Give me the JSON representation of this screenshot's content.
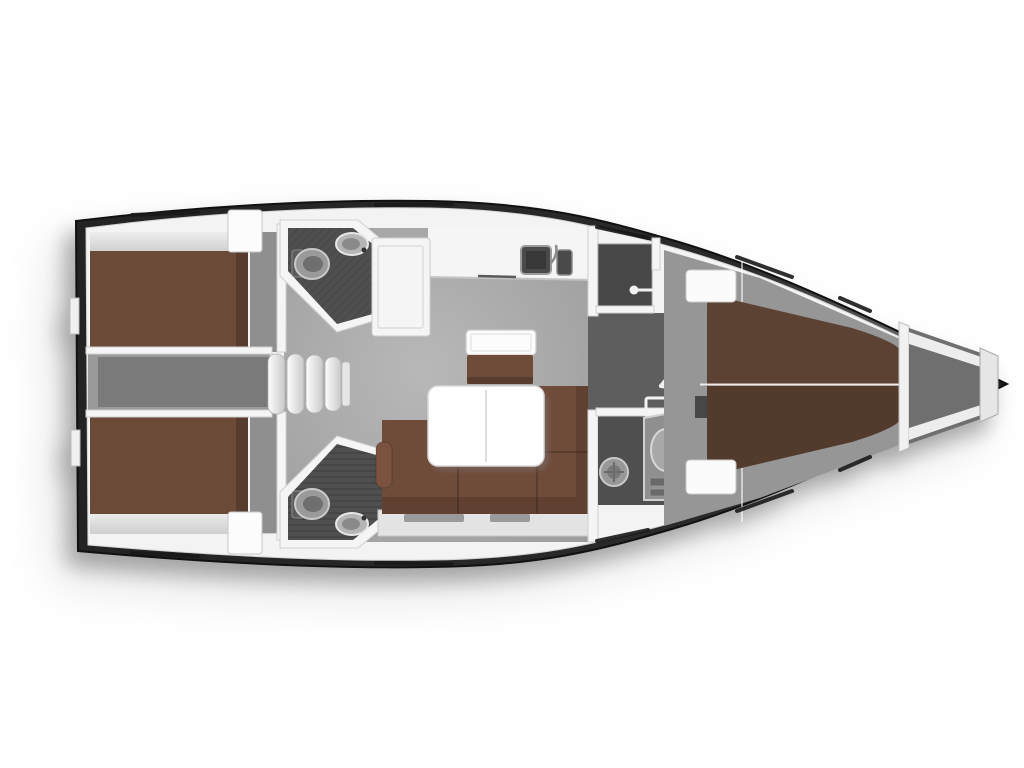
{
  "page": {
    "title": "Sailing yacht interior layout plan (top view)",
    "background": "#ffffff"
  },
  "diagram": {
    "type": "yacht-floor-plan",
    "orientation": {
      "bow": "right",
      "stern": "left",
      "port_side": "top",
      "starboard_side": "bottom"
    },
    "colors": {
      "hull_dark": "#232323",
      "bow_sheen": "#757575",
      "deck": "#f3f3f3",
      "shelf": "#dcdcdc",
      "floor": "#a6a6a6",
      "corridor": "#9a9a9a",
      "corridor_inner": "#7a7a7a",
      "passage": "#5e5e5e",
      "wet_floor": "#4f4f4f",
      "wardrobe": "#474747",
      "bed_brown": "#6b4a38",
      "fwd_bed_brown": "#5c4233",
      "sofa_brown": "#6f4b3a",
      "sofa_arm": "#7a523f",
      "fixture": "#969696",
      "table_white": "#ffffff",
      "counter_white": "#f5f5f5",
      "sink_dark": "#4a4a4a",
      "hatch_slit": "#191919",
      "anchor_locker": "#6f6f6f"
    },
    "rooms": [
      {
        "name": "aft-cabin-port",
        "label": "aft double cabin port"
      },
      {
        "name": "aft-cabin-starboard",
        "label": "aft double cabin starboard"
      },
      {
        "name": "aft-head-port",
        "label": "aft bathroom port"
      },
      {
        "name": "aft-head-starboard",
        "label": "aft bathroom starboard"
      },
      {
        "name": "companionway",
        "label": "companionway steps"
      },
      {
        "name": "saloon",
        "label": "saloon"
      },
      {
        "name": "galley",
        "label": "L-shaped galley"
      },
      {
        "name": "wardrobe",
        "label": "hanging locker"
      },
      {
        "name": "forward-head",
        "label": "forward bathroom"
      },
      {
        "name": "forward-cabin",
        "label": "forward V-berth cabin"
      },
      {
        "name": "anchor-locker",
        "label": "anchor locker"
      }
    ],
    "furniture": [
      "double-berth",
      "double-berth",
      "v-berth",
      "l-shaped-settee",
      "saloon-table",
      "seat-chest",
      "galley-counter",
      "sink",
      "stove",
      "toilet",
      "washbasin",
      "clothes-rail",
      "companionway-steps",
      "bow-struts"
    ]
  }
}
